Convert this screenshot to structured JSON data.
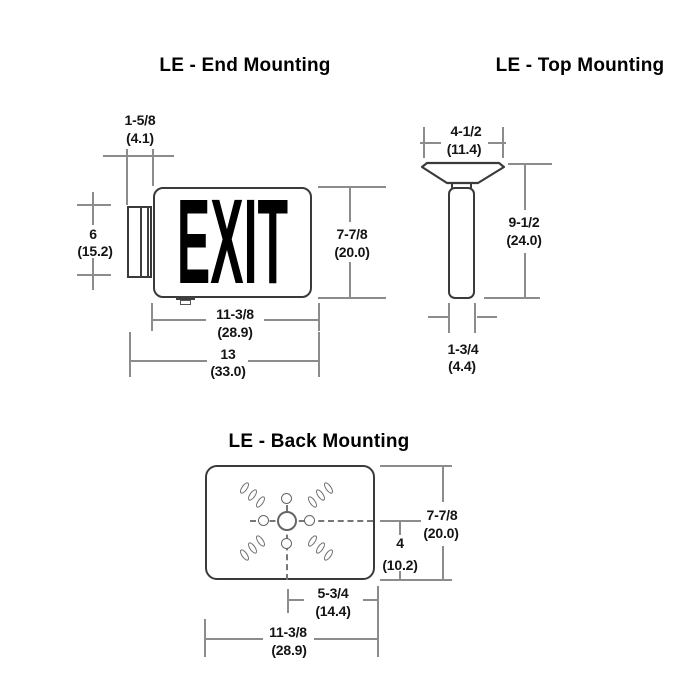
{
  "end_mounting": {
    "title": "LE - End Mounting",
    "sign_text": "EXIT",
    "dims": {
      "bracket_width": {
        "in": "1-5/8",
        "cm": "(4.1)"
      },
      "bracket_height": {
        "in": "6",
        "cm": "(15.2)"
      },
      "sign_height": {
        "in": "7-7/8",
        "cm": "(20.0)"
      },
      "sign_width": {
        "in": "11-3/8",
        "cm": "(28.9)"
      },
      "total_width": {
        "in": "13",
        "cm": "(33.0)"
      }
    }
  },
  "top_mounting": {
    "title": "LE - Top Mounting",
    "dims": {
      "canopy_width": {
        "in": "4-1/2",
        "cm": "(11.4)"
      },
      "total_height": {
        "in": "9-1/2",
        "cm": "(24.0)"
      },
      "stem_width": {
        "in": "1-3/4",
        "cm": "(4.4)"
      }
    }
  },
  "back_mounting": {
    "title": "LE - Back Mounting",
    "dims": {
      "plate_height": {
        "in": "7-7/8",
        "cm": "(20.0)"
      },
      "center_to_bottom": {
        "in": "4",
        "cm": "(10.2)"
      },
      "center_to_edge": {
        "in": "5-3/4",
        "cm": "(14.4)"
      },
      "plate_width": {
        "in": "11-3/8",
        "cm": "(28.9)"
      }
    }
  },
  "colors": {
    "outline": "#3a3a3a",
    "dimension_line": "#8c8c8c",
    "text": "#141414"
  }
}
